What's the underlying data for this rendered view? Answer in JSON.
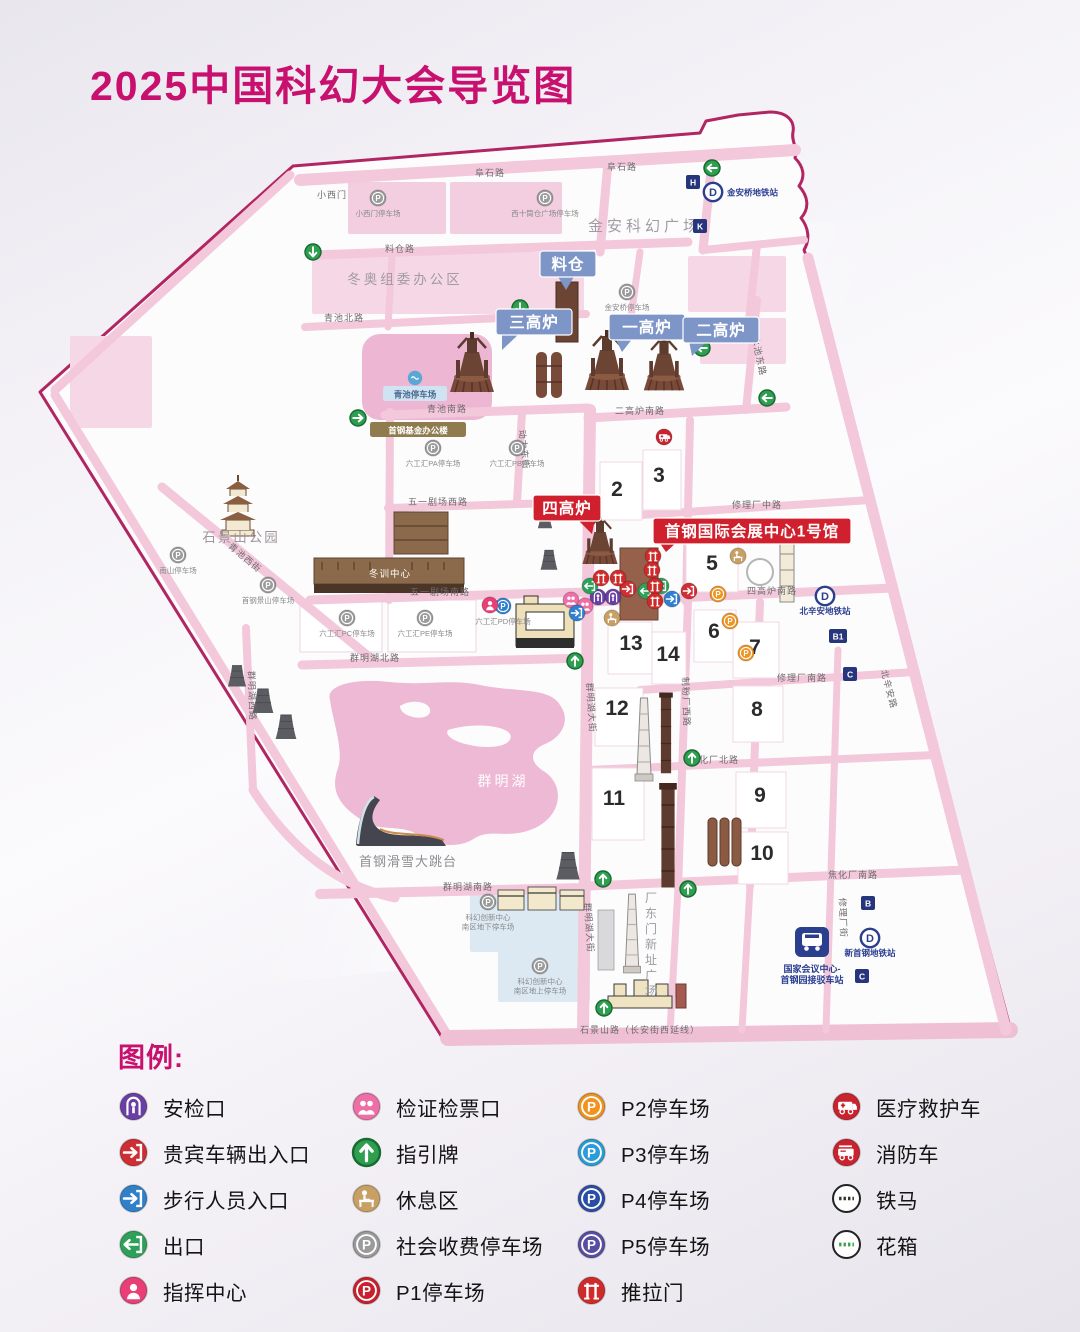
{
  "title": "2025中国科幻大会导览图",
  "legend": {
    "heading": "图例:",
    "columns": [
      [
        {
          "type": "security",
          "color": "#6a3fa3",
          "label": "安检口"
        },
        {
          "type": "vip",
          "color": "#cf2e35",
          "label": "贵宾车辆出入口"
        },
        {
          "type": "enter",
          "color": "#2f80c8",
          "label": "步行人员入口"
        },
        {
          "type": "exit",
          "color": "#2fa05a",
          "label": "出口"
        },
        {
          "type": "command",
          "color": "#e73f76",
          "label": "指挥中心"
        }
      ],
      [
        {
          "type": "ticket",
          "color": "#ed6fa6",
          "label": "检证检票口"
        },
        {
          "type": "arrow",
          "color": "#2e9e4f",
          "label": "指引牌"
        },
        {
          "type": "rest",
          "color": "#c9a063",
          "label": "休息区"
        },
        {
          "type": "parking",
          "color": "#9b9b9b",
          "label": "社会收费停车场"
        },
        {
          "type": "parking",
          "color": "#c9202f",
          "label": "P1停车场"
        }
      ],
      [
        {
          "type": "parking",
          "color": "#ef9321",
          "label": "P2停车场"
        },
        {
          "type": "parking",
          "color": "#2b9cd8",
          "label": "P3停车场"
        },
        {
          "type": "parking",
          "color": "#2a4da5",
          "label": "P4停车场"
        },
        {
          "type": "parking",
          "color": "#584ea2",
          "label": "P5停车场"
        },
        {
          "type": "door",
          "color": "#d02b2b",
          "label": "推拉门"
        }
      ],
      [
        {
          "type": "medical",
          "color": "#c8232f",
          "label": "医疗救护车"
        },
        {
          "type": "fire",
          "color": "#c8232f",
          "label": "消防车"
        },
        {
          "type": "barrier",
          "color": "#ffffff",
          "label": "铁马"
        },
        {
          "type": "planter",
          "color": "#ffffff",
          "label": "花箱"
        }
      ]
    ]
  },
  "map": {
    "road_labels": [
      {
        "t": "阜石路",
        "x": 490,
        "y": 176,
        "r": 0
      },
      {
        "t": "阜石路",
        "x": 622,
        "y": 170,
        "r": 0
      },
      {
        "t": "小西门",
        "x": 332,
        "y": 198,
        "r": 0
      },
      {
        "t": "料仓路",
        "x": 400,
        "y": 252,
        "r": 0
      },
      {
        "t": "青池北路",
        "x": 344,
        "y": 321,
        "r": 0
      },
      {
        "t": "青池南路",
        "x": 447,
        "y": 412,
        "r": 0
      },
      {
        "t": "二高炉南路",
        "x": 640,
        "y": 414,
        "r": 0
      },
      {
        "t": "晾水池东路",
        "x": 755,
        "y": 352,
        "r": 78
      },
      {
        "t": "动力东街",
        "x": 521,
        "y": 450,
        "r": 84
      },
      {
        "t": "五一剧场西路",
        "x": 438,
        "y": 505,
        "r": 0
      },
      {
        "t": "五一剧场南路",
        "x": 440,
        "y": 595,
        "r": 0
      },
      {
        "t": "青池西街",
        "x": 243,
        "y": 560,
        "r": 40
      },
      {
        "t": "群明湖北路",
        "x": 375,
        "y": 661,
        "r": 0
      },
      {
        "t": "群明湖西路",
        "x": 249,
        "y": 696,
        "r": 88
      },
      {
        "t": "群明湖大街",
        "x": 588,
        "y": 708,
        "r": 86
      },
      {
        "t": "群明湖大街",
        "x": 586,
        "y": 928,
        "r": 86
      },
      {
        "t": "群明湖南路",
        "x": 468,
        "y": 890,
        "r": 0
      },
      {
        "t": "焦化厂南路",
        "x": 853,
        "y": 878,
        "r": 0
      },
      {
        "t": "石景山路（长安街西延线）",
        "x": 640,
        "y": 1033,
        "r": 0
      },
      {
        "t": "四高炉南路",
        "x": 772,
        "y": 594,
        "r": 0
      },
      {
        "t": "修理厂中路",
        "x": 757,
        "y": 508,
        "r": 0
      },
      {
        "t": "修理厂南路",
        "x": 802,
        "y": 681,
        "r": 0
      },
      {
        "t": "焦化厂北路",
        "x": 714,
        "y": 763,
        "r": 0
      },
      {
        "t": "北辛安路",
        "x": 886,
        "y": 690,
        "r": 75
      },
      {
        "t": "制粉厂西路",
        "x": 683,
        "y": 702,
        "r": 88
      },
      {
        "t": "修理厂街",
        "x": 840,
        "y": 918,
        "r": 88
      }
    ],
    "area_labels": [
      {
        "t": "金安科幻广场",
        "x": 645,
        "y": 231,
        "s": 15,
        "c": "#a29aa4",
        "ls": 4
      },
      {
        "t": "冬奥组委办公区",
        "x": 405,
        "y": 284,
        "s": 13.5,
        "c": "#a29aa4",
        "ls": 3
      },
      {
        "t": "石景山公园",
        "x": 241,
        "y": 542,
        "s": 13.5,
        "c": "#a0969e",
        "ls": 2
      },
      {
        "t": "群明湖",
        "x": 503,
        "y": 786,
        "s": 14,
        "c": "#ffffff",
        "ls": 3
      },
      {
        "t": "首钢滑雪大跳台",
        "x": 408,
        "y": 866,
        "s": 13,
        "c": "#8d8d92",
        "ls": 1
      },
      {
        "t": "厂东门新址广场",
        "x": 651,
        "y": 902,
        "s": 12,
        "c": "#9a9aa0",
        "vert": true
      },
      {
        "t": "冬训中心",
        "x": 390,
        "y": 577,
        "s": 9.5,
        "c": "#ffffff",
        "ls": 1
      }
    ],
    "halls": [
      {
        "n": "2",
        "x": 617,
        "y": 496
      },
      {
        "n": "3",
        "x": 659,
        "y": 482
      },
      {
        "n": "5",
        "x": 712,
        "y": 570
      },
      {
        "n": "6",
        "x": 714,
        "y": 638
      },
      {
        "n": "7",
        "x": 755,
        "y": 654
      },
      {
        "n": "8",
        "x": 757,
        "y": 716
      },
      {
        "n": "9",
        "x": 760,
        "y": 802
      },
      {
        "n": "10",
        "x": 762,
        "y": 860
      },
      {
        "n": "11",
        "x": 614,
        "y": 805
      },
      {
        "n": "12",
        "x": 617,
        "y": 715
      },
      {
        "n": "13",
        "x": 631,
        "y": 650
      },
      {
        "n": "14",
        "x": 668,
        "y": 661
      }
    ],
    "callouts": [
      {
        "t": "料仓",
        "x": 568,
        "y": 264,
        "w": 56,
        "bg": "#7e95c7",
        "tx": 566,
        "ty": 290
      },
      {
        "t": "三高炉",
        "x": 534,
        "y": 322,
        "w": 76,
        "bg": "#7e95c7",
        "tx": 502,
        "ty": 350
      },
      {
        "t": "一高炉",
        "x": 647,
        "y": 327,
        "w": 76,
        "bg": "#7e95c7",
        "tx": 622,
        "ty": 352
      },
      {
        "t": "二高炉",
        "x": 721,
        "y": 330,
        "w": 76,
        "bg": "#7e95c7",
        "tx": 692,
        "ty": 356
      },
      {
        "t": "四高炉",
        "x": 567,
        "y": 508,
        "w": 68,
        "bg": "#d01f2d",
        "tx": 592,
        "ty": 534
      },
      {
        "t": "首钢国际会展中心1号馆",
        "x": 752,
        "y": 531,
        "w": 198,
        "bg": "#d01f2d",
        "tx": 666,
        "ty": 552
      }
    ],
    "markers": [
      {
        "type": "arrow",
        "x": 313,
        "y": 252,
        "dir": "d"
      },
      {
        "type": "arrow",
        "x": 520,
        "y": 308,
        "dir": "d"
      },
      {
        "type": "arrow",
        "x": 712,
        "y": 168,
        "dir": "l"
      },
      {
        "type": "arrow",
        "x": 702,
        "y": 348,
        "dir": "l"
      },
      {
        "type": "arrow",
        "x": 767,
        "y": 398,
        "dir": "l"
      },
      {
        "type": "arrow",
        "x": 358,
        "y": 418,
        "dir": "r"
      },
      {
        "type": "arrow",
        "x": 575,
        "y": 661,
        "dir": "u"
      },
      {
        "type": "arrow",
        "x": 692,
        "y": 758,
        "dir": "u"
      },
      {
        "type": "arrow",
        "x": 603,
        "y": 879,
        "dir": "u"
      },
      {
        "type": "arrow",
        "x": 688,
        "y": 889,
        "dir": "u"
      },
      {
        "type": "arrow",
        "x": 604,
        "y": 1008,
        "dir": "u"
      },
      {
        "type": "parking",
        "color": "#9b9b9b",
        "x": 378,
        "y": 198,
        "label": [
          "小西门停车场"
        ]
      },
      {
        "type": "parking",
        "color": "#9b9b9b",
        "x": 545,
        "y": 198,
        "label": [
          "西十筒仓广场停车场"
        ]
      },
      {
        "type": "parking",
        "color": "#9b9b9b",
        "x": 627,
        "y": 292,
        "label": [
          "金安桥停车场"
        ]
      },
      {
        "type": "parking",
        "color": "#9b9b9b",
        "x": 433,
        "y": 448,
        "label": [
          "六工汇PA停车场"
        ]
      },
      {
        "type": "parking",
        "color": "#9b9b9b",
        "x": 517,
        "y": 448,
        "label": [
          "六工汇PB停车场"
        ]
      },
      {
        "type": "parking",
        "color": "#9b9b9b",
        "x": 178,
        "y": 555,
        "label": [
          "南山停车场"
        ]
      },
      {
        "type": "parking",
        "color": "#9b9b9b",
        "x": 268,
        "y": 585,
        "label": [
          "首钢景山停车场"
        ]
      },
      {
        "type": "parking",
        "color": "#9b9b9b",
        "x": 347,
        "y": 618,
        "label": [
          "六工汇PC停车场"
        ]
      },
      {
        "type": "parking",
        "color": "#9b9b9b",
        "x": 425,
        "y": 618,
        "label": [
          "六工汇PE停车场"
        ]
      },
      {
        "type": "parking",
        "color": "#2f7fd0",
        "x": 503,
        "y": 606,
        "label": [
          "六工汇PD停车场"
        ]
      },
      {
        "type": "parking",
        "color": "#9b9b9b",
        "x": 488,
        "y": 902,
        "label": [
          "科幻创新中心",
          "南区地下停车场"
        ]
      },
      {
        "type": "parking",
        "color": "#9b9b9b",
        "x": 540,
        "y": 966,
        "label": [
          "科幻创新中心",
          "南区地上停车场"
        ]
      },
      {
        "type": "security",
        "color": "#6a3fa3",
        "x": 598,
        "y": 597
      },
      {
        "type": "security",
        "color": "#6a3fa3",
        "x": 613,
        "y": 597
      },
      {
        "type": "ticket",
        "color": "#ed6fa6",
        "x": 571,
        "y": 600
      },
      {
        "type": "ticket",
        "color": "#ed6fa6",
        "x": 585,
        "y": 606
      },
      {
        "type": "command",
        "color": "#e73f76",
        "x": 490,
        "y": 605
      },
      {
        "type": "enter",
        "color": "#2f7fd0",
        "x": 577,
        "y": 613
      },
      {
        "type": "enter",
        "color": "#2f7fd0",
        "x": 672,
        "y": 599
      },
      {
        "type": "exit",
        "color": "#2fa05a",
        "x": 590,
        "y": 586
      },
      {
        "type": "exit",
        "color": "#2fa05a",
        "x": 646,
        "y": 591
      },
      {
        "type": "exit",
        "color": "#2fa05a",
        "x": 661,
        "y": 586
      },
      {
        "type": "vip",
        "color": "#cf2e35",
        "x": 628,
        "y": 589
      },
      {
        "type": "vip",
        "color": "#cf2e35",
        "x": 689,
        "y": 591
      },
      {
        "type": "door",
        "color": "#d02b2b",
        "x": 601,
        "y": 578
      },
      {
        "type": "door",
        "color": "#d02b2b",
        "x": 618,
        "y": 578
      },
      {
        "type": "door",
        "color": "#d02b2b",
        "x": 653,
        "y": 556
      },
      {
        "type": "door",
        "color": "#d02b2b",
        "x": 652,
        "y": 570
      },
      {
        "type": "door",
        "color": "#d02b2b",
        "x": 655,
        "y": 586
      },
      {
        "type": "door",
        "color": "#d02b2b",
        "x": 655,
        "y": 601
      },
      {
        "type": "parking",
        "color": "#ef9321",
        "x": 718,
        "y": 594
      },
      {
        "type": "parking",
        "color": "#ef9321",
        "x": 730,
        "y": 621
      },
      {
        "type": "parking",
        "color": "#ef9321",
        "x": 746,
        "y": 653
      },
      {
        "type": "rest",
        "color": "#c9a063",
        "x": 612,
        "y": 618
      },
      {
        "type": "rest",
        "color": "#c9a063",
        "x": 738,
        "y": 556
      },
      {
        "type": "medical",
        "color": "#c8232f",
        "x": 664,
        "y": 437
      },
      {
        "type": "wave",
        "x": 415,
        "y": 378
      },
      {
        "type": "metro",
        "x": 713,
        "y": 192,
        "label": [
          "金安桥地铁站"
        ],
        "lpos": "right"
      },
      {
        "type": "metro",
        "x": 825,
        "y": 596,
        "label": [
          "北辛安地铁站"
        ]
      },
      {
        "type": "metro",
        "x": 870,
        "y": 938,
        "label": [
          "新首钢地铁站"
        ]
      },
      {
        "type": "square",
        "x": 693,
        "y": 182,
        "letter": "H"
      },
      {
        "type": "square",
        "x": 700,
        "y": 226,
        "letter": "K"
      },
      {
        "type": "square",
        "x": 838,
        "y": 636,
        "letter": "B1"
      },
      {
        "type": "square",
        "x": 850,
        "y": 674,
        "letter": "C"
      },
      {
        "type": "square",
        "x": 868,
        "y": 903,
        "letter": "B"
      },
      {
        "type": "square",
        "x": 862,
        "y": 976,
        "letter": "C"
      },
      {
        "type": "pill",
        "x": 418,
        "y": 430,
        "bg": "#8f7b4e",
        "fg": "#ffffff",
        "w": 96,
        "label": [
          "首钢基金办公楼"
        ]
      },
      {
        "type": "pill",
        "x": 415,
        "y": 394,
        "bg": "#cfe3f2",
        "fg": "#49688c",
        "w": 64,
        "label": [
          "青池停车场"
        ]
      },
      {
        "type": "bus",
        "x": 812,
        "y": 942,
        "label": [
          "国家会议中心-",
          "首钢园接驳车站"
        ]
      }
    ]
  }
}
